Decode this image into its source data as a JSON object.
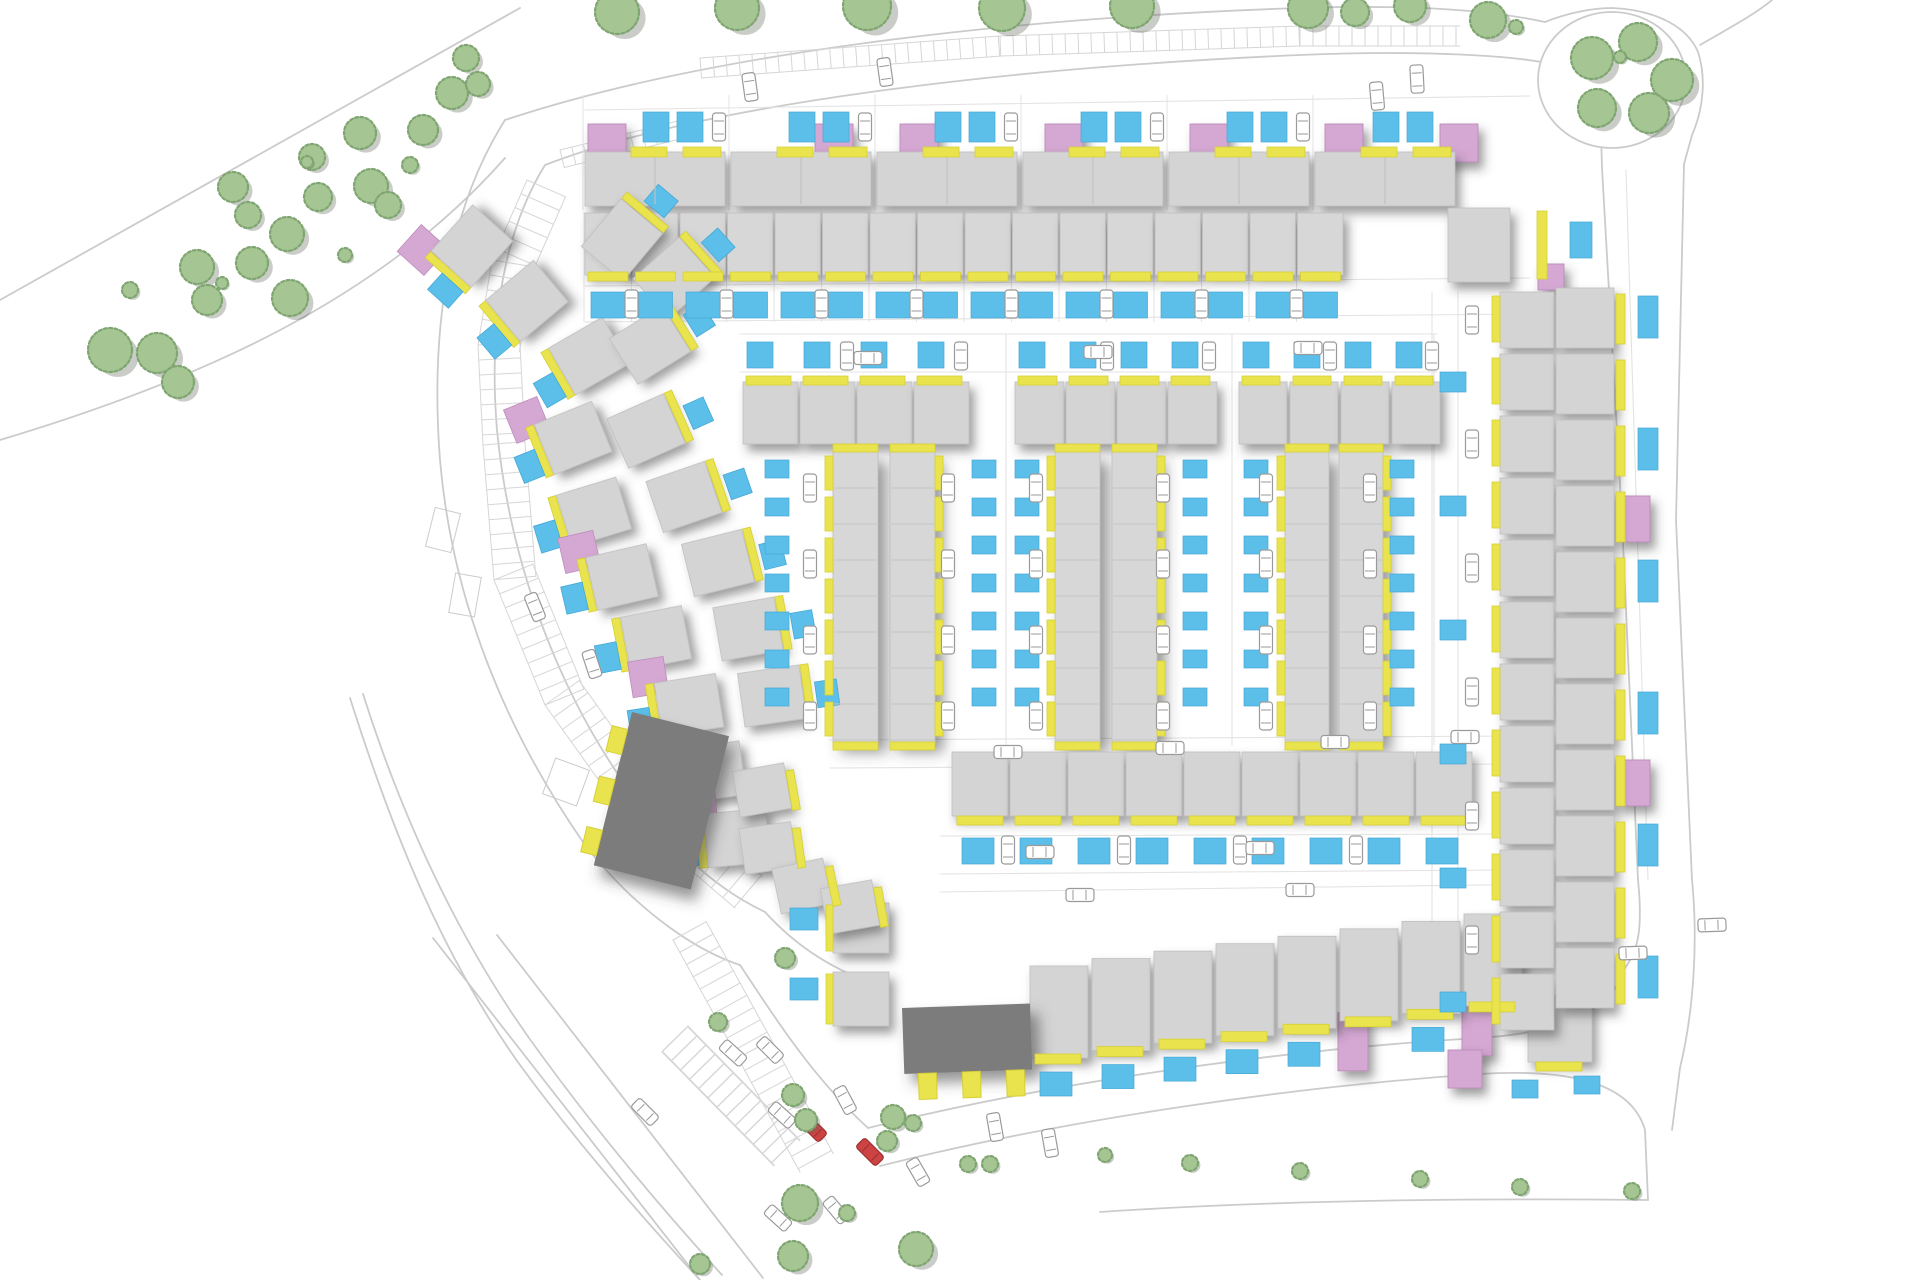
{
  "document": {
    "title": "Residential development site plan"
  },
  "canvas": {
    "width": 1920,
    "height": 1280,
    "background": "#ffffff"
  },
  "palette": {
    "house": "#d4d4d4",
    "house_edge": "#bfbfbf",
    "terrace": "#d7d7d7",
    "dark_building": "#7b7b7b",
    "accent_pink": "#d5a7d3",
    "accent_pink_edge": "#bd8cbc",
    "accent_yellow": "#e9e44e",
    "accent_yellow_edge": "#d6cf35",
    "parking_blue": "#5bbfe9",
    "parking_blue_edge": "#45a9d6",
    "tree_fill": "#a5c593",
    "tree_edge": "#7fa571",
    "tree_shadow": "rgba(100,110,95,0.35)",
    "road_line": "#cbcbcb",
    "lot_line": "#e3e3e3",
    "hatch": "#d6d6d6",
    "car_body": "#ffffff",
    "car_edge": "#9a9a9a",
    "car_red": "#cd4343"
  },
  "roads": [
    "M0,300 L520,8",
    "M0,440 C200,380 380,300 505,158",
    "M505,120 C700,55 1000,18 1300,8 C1400,5 1480,8 1545,22",
    "M545,165 C700,105 1000,68 1300,55 C1420,50 1520,55 1560,66 C1585,74 1596,80 1600,95 L1602,168",
    "M1545,22 C1565,14 1590,8 1612,8 C1658,10 1688,28 1698,52 C1706,76 1704,108 1692,135 L1684,164",
    "M1700,45 C1735,25 1758,12 1772,0",
    "M505,120 C448,210 430,330 440,460 C452,600 505,730 585,845 C640,915 700,952 740,965",
    "M545,165 C505,230 488,320 497,430 C510,565 560,700 640,805 C685,862 725,893 765,912",
    "M1602,168 L1622,520 L1638,880 C1643,930 1638,950 1625,968",
    "M1684,164 L1676,520 L1692,880 C1698,940 1694,1010 1680,1068 L1672,1130",
    "M868,1128 C1060,1080 1300,1048 1480,1038 C1570,1032 1612,1008 1625,968",
    "M880,1166 C1070,1118 1300,1086 1480,1074 C1575,1068 1632,1085 1645,1130 L1648,1200",
    "M1100,1212 C1280,1200 1470,1198 1648,1200",
    "M765,912 C795,945 830,968 870,982",
    "M740,965 C770,1010 810,1075 868,1128",
    "M350,698 C395,840 445,960 520,1065 C575,1140 640,1215 700,1280",
    "M363,694 C408,836 470,960 545,1060 C600,1135 663,1210 722,1275",
    "M433,938 L700,1280",
    "M497,935 L763,1278"
  ],
  "lanes": [
    "M585,110 L1530,96",
    "M585,286 L1530,278",
    "M585,322 L1530,314",
    "M740,334 L1437,334",
    "M740,372 L1437,372",
    "M830,740 L1520,736",
    "M830,768 L1520,764",
    "M940,836 L1500,834",
    "M940,874 L1500,870",
    "M940,892 L1560,884",
    "M1432,292 L1432,1000",
    "M1458,292 L1458,1000",
    "M1006,334 L1006,745",
    "M1232,334 L1232,745",
    "M1434,334 L1434,745",
    "M1626,170 L1648,880"
  ],
  "hatch_bands": [
    {
      "pts": [
        [
          700,
          58
        ],
        [
          1000,
          36
        ],
        [
          1300,
          26
        ],
        [
          1460,
          26
        ]
      ],
      "depth": 20,
      "step": 13,
      "side": 1
    },
    {
      "pts": [
        [
          560,
          150
        ],
        [
          690,
          118
        ]
      ],
      "depth": 18,
      "step": 12,
      "side": 1
    },
    {
      "pts": [
        [
          527,
          180
        ],
        [
          492,
          260
        ],
        [
          478,
          345
        ],
        [
          483,
          445
        ],
        [
          494,
          580
        ],
        [
          545,
          705
        ],
        [
          620,
          810
        ],
        [
          735,
          908
        ]
      ],
      "depth": 42,
      "step": 15,
      "side": -1
    },
    {
      "pts": [
        [
          673,
          940
        ],
        [
          738,
          1058
        ],
        [
          800,
          1172
        ]
      ],
      "depth": 38,
      "step": 14,
      "side": -1
    },
    {
      "pts": [
        [
          688,
          1026
        ],
        [
          800,
          1140
        ]
      ],
      "depth": 36,
      "step": 13,
      "side": 1
    },
    {
      "pts": [
        [
          662,
          1052
        ],
        [
          774,
          1166
        ]
      ],
      "depth": 36,
      "step": 13,
      "side": -1
    }
  ],
  "island": {
    "cx": 1612,
    "cy": 80,
    "rx": 74,
    "ry": 68
  },
  "bay_outlines": [
    [
      548,
      763,
      36,
      38,
      20
    ],
    [
      430,
      510,
      26,
      40,
      14
    ],
    [
      452,
      575,
      26,
      40,
      10
    ]
  ],
  "row_a": {
    "pairs": [
      585,
      731,
      877,
      1023,
      1169,
      1315
    ],
    "pair_w": 140,
    "house_y": 152,
    "house_h": 54,
    "pinks": [
      588,
      815,
      900,
      1045,
      1190,
      1325,
      1440
    ],
    "pink_y": 124,
    "pink_w": 38,
    "pink_h": 38,
    "yellow_y": 147,
    "pad_y": 112
  },
  "row_b": {
    "x0": 585,
    "step": 47.5,
    "count": 16,
    "y": 213,
    "h": 62,
    "pad_y": 292
  },
  "corner_ne": [
    {
      "t": "house",
      "x": 1448,
      "y": 208,
      "w": 62,
      "h": 74
    },
    {
      "t": "yellow",
      "x": 1537,
      "y": 211,
      "w": 10,
      "h": 68
    },
    {
      "t": "pink",
      "x": 1538,
      "y": 264,
      "w": 26,
      "h": 26
    },
    {
      "t": "blue",
      "x": 1570,
      "y": 222,
      "w": 22,
      "h": 36
    }
  ],
  "court_y": {
    "pad_y": 342,
    "strip_y": 376,
    "house_y": 382,
    "house_h": 62,
    "terr_y": 452,
    "terr_h": 290
  },
  "courts": [
    {
      "top_x": [
        743,
        800,
        857,
        914
      ],
      "unit_w": 55,
      "terr": [
        833,
        890
      ],
      "terr_w": 45,
      "pads_w": 765,
      "pads_e": 972,
      "car_w": 810,
      "car_e": 948
    },
    {
      "top_x": [
        1015,
        1066,
        1117,
        1168
      ],
      "unit_w": 49,
      "terr": [
        1055,
        1112
      ],
      "terr_w": 45,
      "pads_w": 1015,
      "pads_e": 1183,
      "car_w": 1036,
      "car_e": 1163
    },
    {
      "top_x": [
        1239,
        1290,
        1341,
        1392
      ],
      "unit_w": 48,
      "terr": [
        1285,
        1339
      ],
      "terr_w": 44,
      "pads_w": 1244,
      "pads_e": 1390,
      "car_w": 1266,
      "car_e": 1370
    }
  ],
  "row_c": {
    "x0": 952,
    "step": 58,
    "count": 9,
    "y": 752,
    "h": 64
  },
  "row_d": {
    "x0": 1030,
    "step": 62,
    "count": 8,
    "y_base": 1058,
    "slope": 0.12,
    "h": 92,
    "pink_units": [
      5,
      7
    ]
  },
  "col_r1": {
    "x": 1500,
    "y0": 292,
    "step": 62,
    "count": 12,
    "w": 54,
    "h": 56
  },
  "col_r2": {
    "x": 1556,
    "y0": 288,
    "step": 66,
    "count": 11,
    "w": 58,
    "h": 60,
    "pink_units": [
      3,
      7
    ]
  },
  "arc_outer": [
    [
      472,
      246,
      48,
      1
    ],
    [
      527,
      301,
      40,
      0
    ],
    [
      589,
      356,
      30,
      0
    ],
    [
      573,
      438,
      22,
      1
    ],
    [
      594,
      512,
      17,
      0
    ],
    [
      622,
      577,
      13,
      1
    ],
    [
      656,
      638,
      11,
      0
    ],
    [
      689,
      705,
      9,
      1
    ],
    [
      712,
      772,
      8,
      0
    ],
    [
      737,
      838,
      5,
      1
    ]
  ],
  "arc_inner": [
    [
      622,
      240,
      50
    ],
    [
      674,
      278,
      42
    ],
    [
      650,
      345,
      32
    ],
    [
      646,
      431,
      24
    ],
    [
      684,
      497,
      19
    ],
    [
      718,
      563,
      14
    ],
    [
      748,
      629,
      10
    ],
    [
      772,
      696,
      8
    ]
  ],
  "arc_tail": [
    [
      762,
      790,
      10
    ],
    [
      768,
      848,
      8
    ],
    [
      802,
      886,
      12
    ],
    [
      850,
      907,
      10
    ]
  ],
  "dark_buildings": [
    {
      "x": 632,
      "y": 712,
      "w": 100,
      "h": 158,
      "rot": 14,
      "tabs": "w"
    },
    {
      "x": 902,
      "y": 1008,
      "w": 128,
      "h": 66,
      "rot": -2,
      "tabs": "s"
    }
  ],
  "west_pair": [
    {
      "t": "house",
      "x": 833,
      "y": 903,
      "w": 56,
      "h": 50
    },
    {
      "t": "house",
      "x": 833,
      "y": 972,
      "w": 56,
      "h": 54
    },
    {
      "t": "yellow",
      "x": 826,
      "y": 905,
      "w": 7,
      "h": 46
    },
    {
      "t": "yellow",
      "x": 826,
      "y": 974,
      "w": 7,
      "h": 50
    },
    {
      "t": "blue",
      "x": 790,
      "y": 908,
      "w": 28,
      "h": 22
    },
    {
      "t": "blue",
      "x": 790,
      "y": 978,
      "w": 28,
      "h": 22
    }
  ],
  "corner_se": [
    {
      "t": "house",
      "x": 1528,
      "y": 996,
      "w": 64,
      "h": 66
    },
    {
      "t": "yellow",
      "x": 1536,
      "y": 1062,
      "w": 46,
      "h": 9
    },
    {
      "t": "pink",
      "x": 1448,
      "y": 1050,
      "w": 34,
      "h": 38
    },
    {
      "t": "blue",
      "x": 1512,
      "y": 1080,
      "w": 26,
      "h": 18
    },
    {
      "t": "blue",
      "x": 1574,
      "y": 1076,
      "w": 26,
      "h": 18
    }
  ],
  "cars": [
    [
      750,
      87,
      -8,
      0
    ],
    [
      885,
      72,
      -8,
      0
    ],
    [
      1377,
      96,
      -5,
      0
    ],
    [
      1417,
      79,
      -3,
      0
    ],
    [
      868,
      358,
      90,
      0
    ],
    [
      1098,
      352,
      90,
      0
    ],
    [
      1308,
      348,
      90,
      0
    ],
    [
      1008,
      752,
      90,
      0
    ],
    [
      1170,
      748,
      90,
      0
    ],
    [
      1335,
      742,
      90,
      0
    ],
    [
      1465,
      737,
      90,
      0
    ],
    [
      1040,
      852,
      90,
      0
    ],
    [
      1260,
      848,
      90,
      0
    ],
    [
      1080,
      895,
      90,
      0
    ],
    [
      1300,
      890,
      90,
      0
    ],
    [
      535,
      607,
      -22,
      0
    ],
    [
      592,
      664,
      -18,
      0
    ],
    [
      645,
      1112,
      -45,
      0
    ],
    [
      770,
      1050,
      -45,
      0
    ],
    [
      733,
      1053,
      -48,
      0
    ],
    [
      782,
      1115,
      -48,
      0
    ],
    [
      845,
      1100,
      -28,
      0
    ],
    [
      813,
      1128,
      -45,
      1
    ],
    [
      870,
      1152,
      -45,
      1
    ],
    [
      778,
      1218,
      -48,
      0
    ],
    [
      836,
      1210,
      -40,
      0
    ],
    [
      918,
      1172,
      -30,
      0
    ],
    [
      995,
      1127,
      -10,
      0
    ],
    [
      1050,
      1143,
      -10,
      0
    ],
    [
      1633,
      953,
      88,
      0
    ],
    [
      1712,
      925,
      88,
      0
    ]
  ],
  "trees": [
    [
      110,
      350,
      22
    ],
    [
      157,
      353,
      20
    ],
    [
      178,
      382,
      16
    ],
    [
      197,
      267,
      17
    ],
    [
      207,
      300,
      15
    ],
    [
      233,
      187,
      15
    ],
    [
      248,
      215,
      13
    ],
    [
      252,
      263,
      16
    ],
    [
      287,
      234,
      17
    ],
    [
      290,
      298,
      18
    ],
    [
      312,
      157,
      13
    ],
    [
      318,
      197,
      14
    ],
    [
      360,
      133,
      16
    ],
    [
      371,
      186,
      17
    ],
    [
      388,
      205,
      13
    ],
    [
      423,
      130,
      15
    ],
    [
      452,
      93,
      16
    ],
    [
      466,
      58,
      13
    ],
    [
      478,
      84,
      12
    ],
    [
      130,
      290,
      8
    ],
    [
      222,
      283,
      6
    ],
    [
      307,
      162,
      6
    ],
    [
      345,
      255,
      7
    ],
    [
      410,
      165,
      8
    ],
    [
      617,
      12,
      22
    ],
    [
      737,
      8,
      22
    ],
    [
      867,
      6,
      24
    ],
    [
      1002,
      8,
      23
    ],
    [
      1132,
      6,
      22
    ],
    [
      1308,
      8,
      20
    ],
    [
      1355,
      12,
      14
    ],
    [
      1410,
      6,
      16
    ],
    [
      1488,
      20,
      18
    ],
    [
      1516,
      27,
      7
    ],
    [
      1592,
      58,
      21
    ],
    [
      1638,
      42,
      19
    ],
    [
      1672,
      80,
      21
    ],
    [
      1597,
      108,
      19
    ],
    [
      1649,
      113,
      20
    ],
    [
      1620,
      57,
      6
    ],
    [
      785,
      958,
      10
    ],
    [
      718,
      1022,
      9
    ],
    [
      793,
      1095,
      11
    ],
    [
      806,
      1120,
      11
    ],
    [
      893,
      1117,
      12
    ],
    [
      913,
      1123,
      8
    ],
    [
      887,
      1141,
      10
    ],
    [
      800,
      1203,
      18
    ],
    [
      847,
      1213,
      8
    ],
    [
      793,
      1256,
      15
    ],
    [
      916,
      1249,
      17
    ],
    [
      968,
      1164,
      8
    ],
    [
      990,
      1164,
      8
    ],
    [
      700,
      1264,
      10
    ],
    [
      1105,
      1155,
      7
    ],
    [
      1190,
      1163,
      8
    ],
    [
      1300,
      1171,
      8
    ],
    [
      1420,
      1179,
      8
    ],
    [
      1520,
      1187,
      8
    ],
    [
      1632,
      1191,
      8
    ]
  ]
}
